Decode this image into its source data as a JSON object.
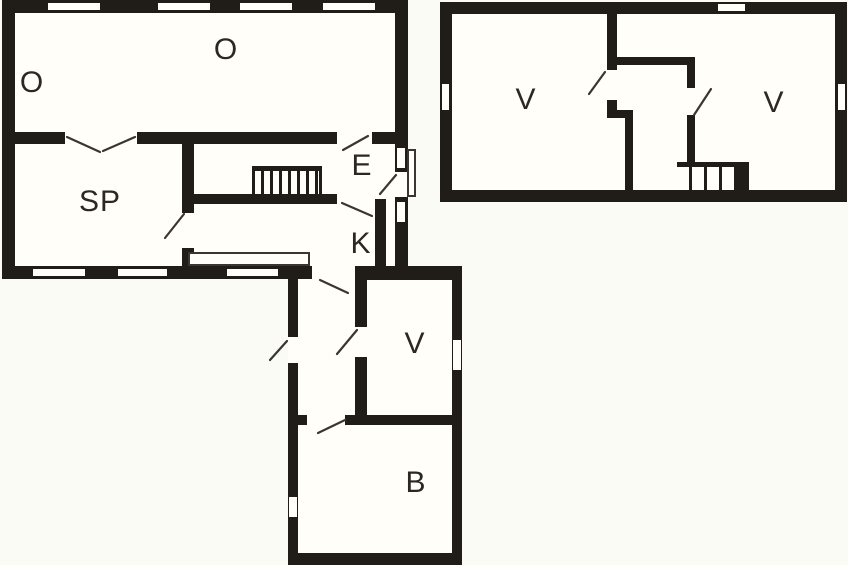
{
  "plans": {
    "ground_floor": {
      "rooms": [
        {
          "label": "O"
        },
        {
          "label": "O"
        },
        {
          "label": "SP"
        },
        {
          "label": "E"
        },
        {
          "label": "K"
        },
        {
          "label": "V"
        },
        {
          "label": "B"
        }
      ]
    },
    "upper_floor": {
      "rooms": [
        {
          "label": "V"
        },
        {
          "label": "V"
        }
      ]
    }
  },
  "colors": {
    "wall": "#201d18",
    "line": "#3a362f",
    "background": "#fbfbf6",
    "room": "#fffef9"
  }
}
